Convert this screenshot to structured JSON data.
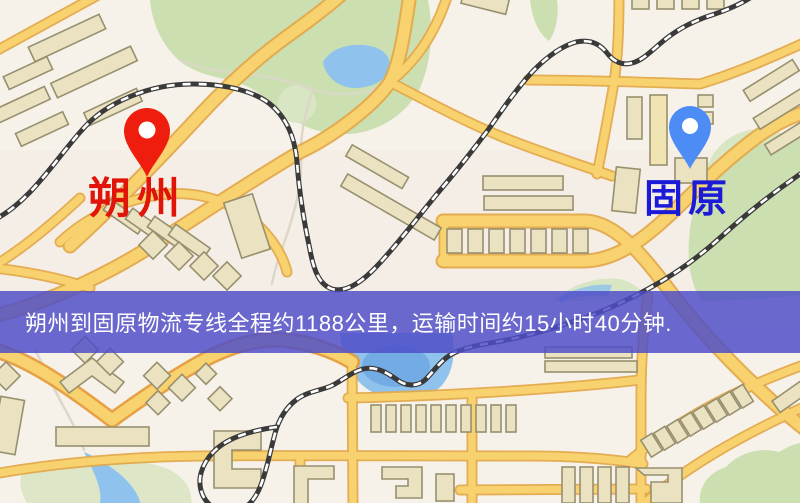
{
  "banner": {
    "text": "朔州到固原物流专线全程约1188公里，运输时间约15小时40分钟.",
    "background_color": "#4f4dc8",
    "text_color": "#ffffff"
  },
  "markers": {
    "origin": {
      "label": "朔州",
      "label_color": "#e01408",
      "pin_color": "#ee1d0d"
    },
    "destination": {
      "label": "固原",
      "label_color": "#1b1ad6",
      "pin_color": "#4d8cf5"
    }
  },
  "route": {
    "origin_city": "朔州",
    "destination_city": "固原",
    "distance_text": "约1188公里",
    "duration_text": "约15小时40分钟"
  },
  "map_colors": {
    "background": "#f7f2e9",
    "road_fill": "#f7d26e",
    "road_casing": "#e3a84b",
    "park_green": "#cbdfb1",
    "water_blue": "#8fc2ed",
    "building_fill": "#ebe2c2",
    "railway_dark": "#3a3a3a"
  }
}
